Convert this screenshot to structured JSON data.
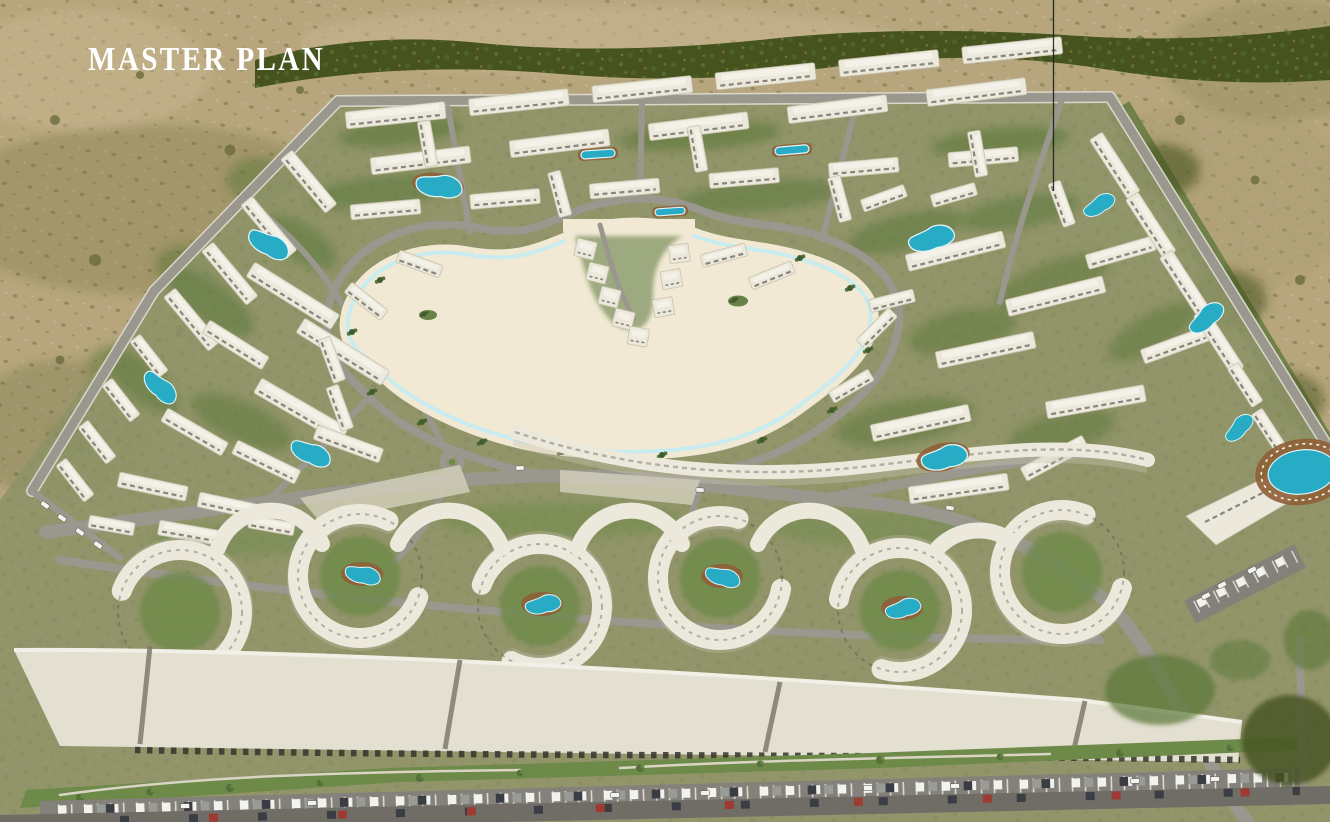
{
  "header": {
    "title": "MASTER PLAN"
  },
  "scene": {
    "kind": "aerial-3d-render-of-residential-master-plan",
    "visible_features": [
      "desert surroundings with shrubs",
      "tree belt along compound edges",
      "central swimmable turquoise lagoon with sand beaches and two palm islands",
      "central peninsula with villas",
      "rows of white low-rise residential buildings",
      "landscaped courtyards with free-form swimming pools",
      "circular wave-shaped apartment blocks with courtyard pools",
      "retail strip with large flat roofs",
      "linear landscaped promenade",
      "parking strips filled with cars",
      "clubhouse wedge building with oval pool and deck",
      "perimeter and curving internal roads"
    ],
    "colors": {
      "desert": "#b7a67d",
      "desert-light": "#c9b893",
      "shrub": "#6b6c3e",
      "tree-band": "#46531f",
      "foliage": "#5a7638",
      "grass": "#6d8a49",
      "site-base": "#8e9468",
      "road": "#9a978e",
      "road-edge": "#dbd7ca",
      "asphalt": "#83817a",
      "asphalt-dark": "#6f6d66",
      "building": "#ece9dc",
      "building-shade": "#c6c1ae",
      "building-detail": "#44423c",
      "lagoon-deep": "#3ab9d5",
      "lagoon-mid": "#5cc8dd",
      "lagoon-shallow": "#9fe2ee",
      "lagoon-fade": "#c9eef4",
      "sand": "#f1e9d4",
      "pool": "#28abc4",
      "pool-deck": "#8f6138",
      "roof": "#e3dfd1",
      "roof-bright": "#f2efe6",
      "title": "#ffffff",
      "annotation": "#1d1d1d",
      "car-white": "#f2f2ee",
      "car-gray": "#9a9a96",
      "car-dark": "#3a3e44",
      "car-red": "#9e3a32",
      "car-blue": "#3d5f84",
      "car-teal": "#2f8a8c"
    }
  }
}
